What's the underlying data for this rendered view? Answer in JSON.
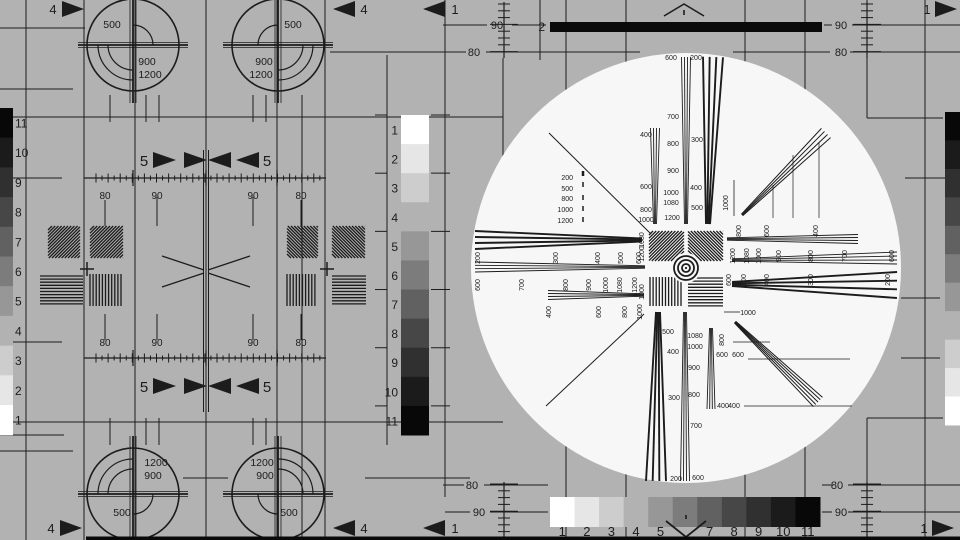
{
  "colors": {
    "bg": "#b2b2b2",
    "ink": "#1c1c1c",
    "circle_fill": "#f7f7f7",
    "bar_black": "#0a0a0a",
    "shades": [
      "#ffffff",
      "#e6e6e6",
      "#cdcdcd",
      "#b2b2b2",
      "#979797",
      "#7c7c7c",
      "#616161",
      "#474747",
      "#303030",
      "#1b1b1b",
      "#080808"
    ]
  },
  "grayscale_left": {
    "numbers": [
      "11",
      "10",
      "9",
      "8",
      "7",
      "6",
      "5",
      "4",
      "3",
      "2",
      "1"
    ]
  },
  "grayscale_center": {
    "numbers": [
      "1",
      "2",
      "3",
      "4",
      "5",
      "6",
      "7",
      "8",
      "9",
      "10",
      "11"
    ]
  },
  "grayscale_bottom": {
    "numbers": [
      "1",
      "2",
      "3",
      "4",
      "5",
      "",
      "7",
      "8",
      "9",
      "10",
      "11"
    ]
  },
  "grayscale_right": {
    "numbers": []
  },
  "top_bar_label": "2",
  "edge_arrows": [
    "4",
    "4",
    "1",
    "1",
    "4",
    "4",
    "1",
    "1"
  ],
  "five_labels": [
    "5",
    "5",
    "5",
    "5"
  ],
  "ruler_labels": [
    {
      "t": "90",
      "x": 497,
      "y": 29
    },
    {
      "t": "90",
      "x": 841,
      "y": 29
    },
    {
      "t": "80",
      "x": 474,
      "y": 56
    },
    {
      "t": "80",
      "x": 841,
      "y": 56
    },
    {
      "t": "80",
      "x": 472,
      "y": 489
    },
    {
      "t": "80",
      "x": 837,
      "y": 489
    },
    {
      "t": "90",
      "x": 479,
      "y": 516
    },
    {
      "t": "90",
      "x": 841,
      "y": 516
    }
  ],
  "pattern_label_rows": [
    {
      "y": 199,
      "items": [
        {
          "t": "80",
          "x": 105
        },
        {
          "t": "90",
          "x": 157
        },
        {
          "t": "90",
          "x": 253
        },
        {
          "t": "80",
          "x": 301
        }
      ]
    },
    {
      "y": 346,
      "items": [
        {
          "t": "80",
          "x": 105
        },
        {
          "t": "90",
          "x": 157
        },
        {
          "t": "90",
          "x": 253
        },
        {
          "t": "80",
          "x": 301
        }
      ]
    }
  ],
  "corner_circles": [
    {
      "cx": 133,
      "cy": 45,
      "small_arc": "ur",
      "double_arc": "ll",
      "labels": [
        {
          "t": "500",
          "x": 112,
          "y": 28
        },
        {
          "t": "900",
          "x": 147,
          "y": 65
        },
        {
          "t": "1200",
          "x": 150,
          "y": 78
        }
      ]
    },
    {
      "cx": 278,
      "cy": 45,
      "small_arc": "ul",
      "double_arc": "lr",
      "labels": [
        {
          "t": "500",
          "x": 293,
          "y": 28
        },
        {
          "t": "900",
          "x": 264,
          "y": 65
        },
        {
          "t": "1200",
          "x": 261,
          "y": 78
        }
      ]
    },
    {
      "cx": 133,
      "cy": 494,
      "small_arc": "lr",
      "double_arc": "ul",
      "labels": [
        {
          "t": "1200",
          "x": 156,
          "y": 466
        },
        {
          "t": "900",
          "x": 153,
          "y": 479
        },
        {
          "t": "500",
          "x": 122,
          "y": 516
        }
      ]
    },
    {
      "cx": 278,
      "cy": 494,
      "small_arc": "ll",
      "double_arc": "ur",
      "labels": [
        {
          "t": "1200",
          "x": 262,
          "y": 466
        },
        {
          "t": "900",
          "x": 265,
          "y": 479
        },
        {
          "t": "500",
          "x": 289,
          "y": 516
        }
      ]
    }
  ],
  "center_labels": [
    {
      "t": "600",
      "x": 671,
      "y": 60
    },
    {
      "t": "200",
      "x": 696,
      "y": 60
    },
    {
      "t": "700",
      "x": 673,
      "y": 119
    },
    {
      "t": "800",
      "x": 673,
      "y": 146
    },
    {
      "t": "900",
      "x": 673,
      "y": 173
    },
    {
      "t": "1000",
      "x": 671,
      "y": 195
    },
    {
      "t": "1080",
      "x": 671,
      "y": 205
    },
    {
      "t": "1200",
      "x": 672,
      "y": 220
    },
    {
      "t": "400",
      "x": 646,
      "y": 137
    },
    {
      "t": "600",
      "x": 646,
      "y": 189
    },
    {
      "t": "800",
      "x": 646,
      "y": 212
    },
    {
      "t": "1000",
      "x": 646,
      "y": 222
    },
    {
      "t": "300",
      "x": 697,
      "y": 142
    },
    {
      "t": "400",
      "x": 696,
      "y": 190
    },
    {
      "t": "500",
      "x": 697,
      "y": 210
    },
    {
      "t": "1080",
      "x": 644,
      "y": 240,
      "r": -90
    },
    {
      "t": "1200",
      "x": 644,
      "y": 254,
      "r": -90
    },
    {
      "t": "1000",
      "x": 644,
      "y": 292,
      "r": -90
    },
    {
      "t": "500",
      "x": 668,
      "y": 334
    },
    {
      "t": "400",
      "x": 673,
      "y": 354
    },
    {
      "t": "300",
      "x": 674,
      "y": 400
    },
    {
      "t": "200",
      "x": 676,
      "y": 481
    },
    {
      "t": "1080",
      "x": 695,
      "y": 338
    },
    {
      "t": "1000",
      "x": 695,
      "y": 349
    },
    {
      "t": "900",
      "x": 694,
      "y": 370
    },
    {
      "t": "800",
      "x": 694,
      "y": 397
    },
    {
      "t": "700",
      "x": 696,
      "y": 428
    },
    {
      "t": "600",
      "x": 698,
      "y": 480
    },
    {
      "t": "600",
      "x": 722,
      "y": 357
    },
    {
      "t": "400",
      "x": 723,
      "y": 408
    },
    {
      "t": "200",
      "x": 480,
      "y": 258,
      "r": -90
    },
    {
      "t": "300",
      "x": 558,
      "y": 258,
      "r": -90
    },
    {
      "t": "400",
      "x": 600,
      "y": 258,
      "r": -90
    },
    {
      "t": "500",
      "x": 623,
      "y": 258,
      "r": -90
    },
    {
      "t": "600",
      "x": 641,
      "y": 258,
      "r": -90
    },
    {
      "t": "600",
      "x": 480,
      "y": 285,
      "r": -90
    },
    {
      "t": "700",
      "x": 524,
      "y": 285,
      "r": -90
    },
    {
      "t": "800",
      "x": 568,
      "y": 285,
      "r": -90
    },
    {
      "t": "900",
      "x": 591,
      "y": 285,
      "r": -90
    },
    {
      "t": "1000",
      "x": 608,
      "y": 285,
      "r": -90
    },
    {
      "t": "1080",
      "x": 622,
      "y": 285,
      "r": -90
    },
    {
      "t": "1200",
      "x": 637,
      "y": 285,
      "r": -90
    },
    {
      "t": "400",
      "x": 551,
      "y": 312,
      "r": -90
    },
    {
      "t": "600",
      "x": 601,
      "y": 312,
      "r": -90
    },
    {
      "t": "800",
      "x": 627,
      "y": 312,
      "r": -90
    },
    {
      "t": "1000",
      "x": 642,
      "y": 312,
      "r": -90
    },
    {
      "t": "800",
      "x": 741,
      "y": 231,
      "r": -90
    },
    {
      "t": "600",
      "x": 769,
      "y": 231,
      "r": -90
    },
    {
      "t": "400",
      "x": 818,
      "y": 231,
      "r": -90
    },
    {
      "t": "1200",
      "x": 735,
      "y": 256,
      "r": -90
    },
    {
      "t": "1080",
      "x": 749,
      "y": 256,
      "r": -90
    },
    {
      "t": "1000",
      "x": 761,
      "y": 256,
      "r": -90
    },
    {
      "t": "900",
      "x": 781,
      "y": 256,
      "r": -90
    },
    {
      "t": "800",
      "x": 813,
      "y": 256,
      "r": -90
    },
    {
      "t": "700",
      "x": 847,
      "y": 256,
      "r": -90
    },
    {
      "t": "600",
      "x": 894,
      "y": 256,
      "r": -90
    },
    {
      "t": "600",
      "x": 731,
      "y": 280,
      "r": -90
    },
    {
      "t": "500",
      "x": 746,
      "y": 280,
      "r": -90
    },
    {
      "t": "400",
      "x": 769,
      "y": 280,
      "r": -90
    },
    {
      "t": "300",
      "x": 813,
      "y": 280,
      "r": -90
    },
    {
      "t": "200",
      "x": 890,
      "y": 280,
      "r": -90
    },
    {
      "t": "1000",
      "x": 728,
      "y": 203,
      "r": -90
    },
    {
      "t": "200",
      "x": 573,
      "y": 180,
      "a": "end"
    },
    {
      "t": "500",
      "x": 573,
      "y": 191,
      "a": "end"
    },
    {
      "t": "800",
      "x": 573,
      "y": 201,
      "a": "end"
    },
    {
      "t": "1000",
      "x": 573,
      "y": 212,
      "a": "end"
    },
    {
      "t": "1200",
      "x": 573,
      "y": 223,
      "a": "end"
    },
    {
      "t": "1000",
      "x": 748,
      "y": 315
    },
    {
      "t": "800",
      "x": 724,
      "y": 340,
      "r": -90
    },
    {
      "t": "600",
      "x": 738,
      "y": 357
    },
    {
      "t": "400",
      "x": 734,
      "y": 408
    }
  ]
}
